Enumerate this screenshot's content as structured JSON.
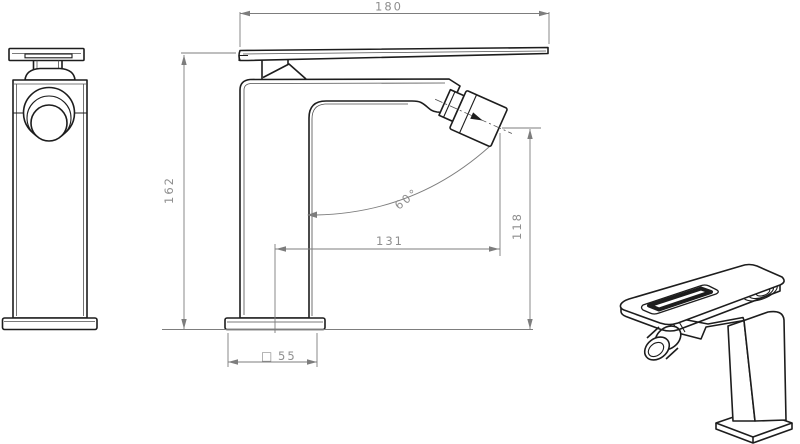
{
  "drawing": {
    "kind": "faucet-technical-drawing",
    "views": {
      "front_view": "front orthographic view",
      "side_view": "side orthographic view with dimensions",
      "perspective_view": "3d perspective view"
    }
  },
  "dimensions": {
    "total_width": "180",
    "total_height": "162",
    "spout_reach": "131",
    "aerator_height": "118",
    "spray_angle": "60°",
    "base_symbol": "□",
    "base_size": "55"
  },
  "colors": {
    "background": "#ffffff",
    "outline": "#1d1d1d",
    "thin_line": "#4f4f4f",
    "dimension_line": "#7d7d7d",
    "dimension_text": "#8e8e8e"
  }
}
